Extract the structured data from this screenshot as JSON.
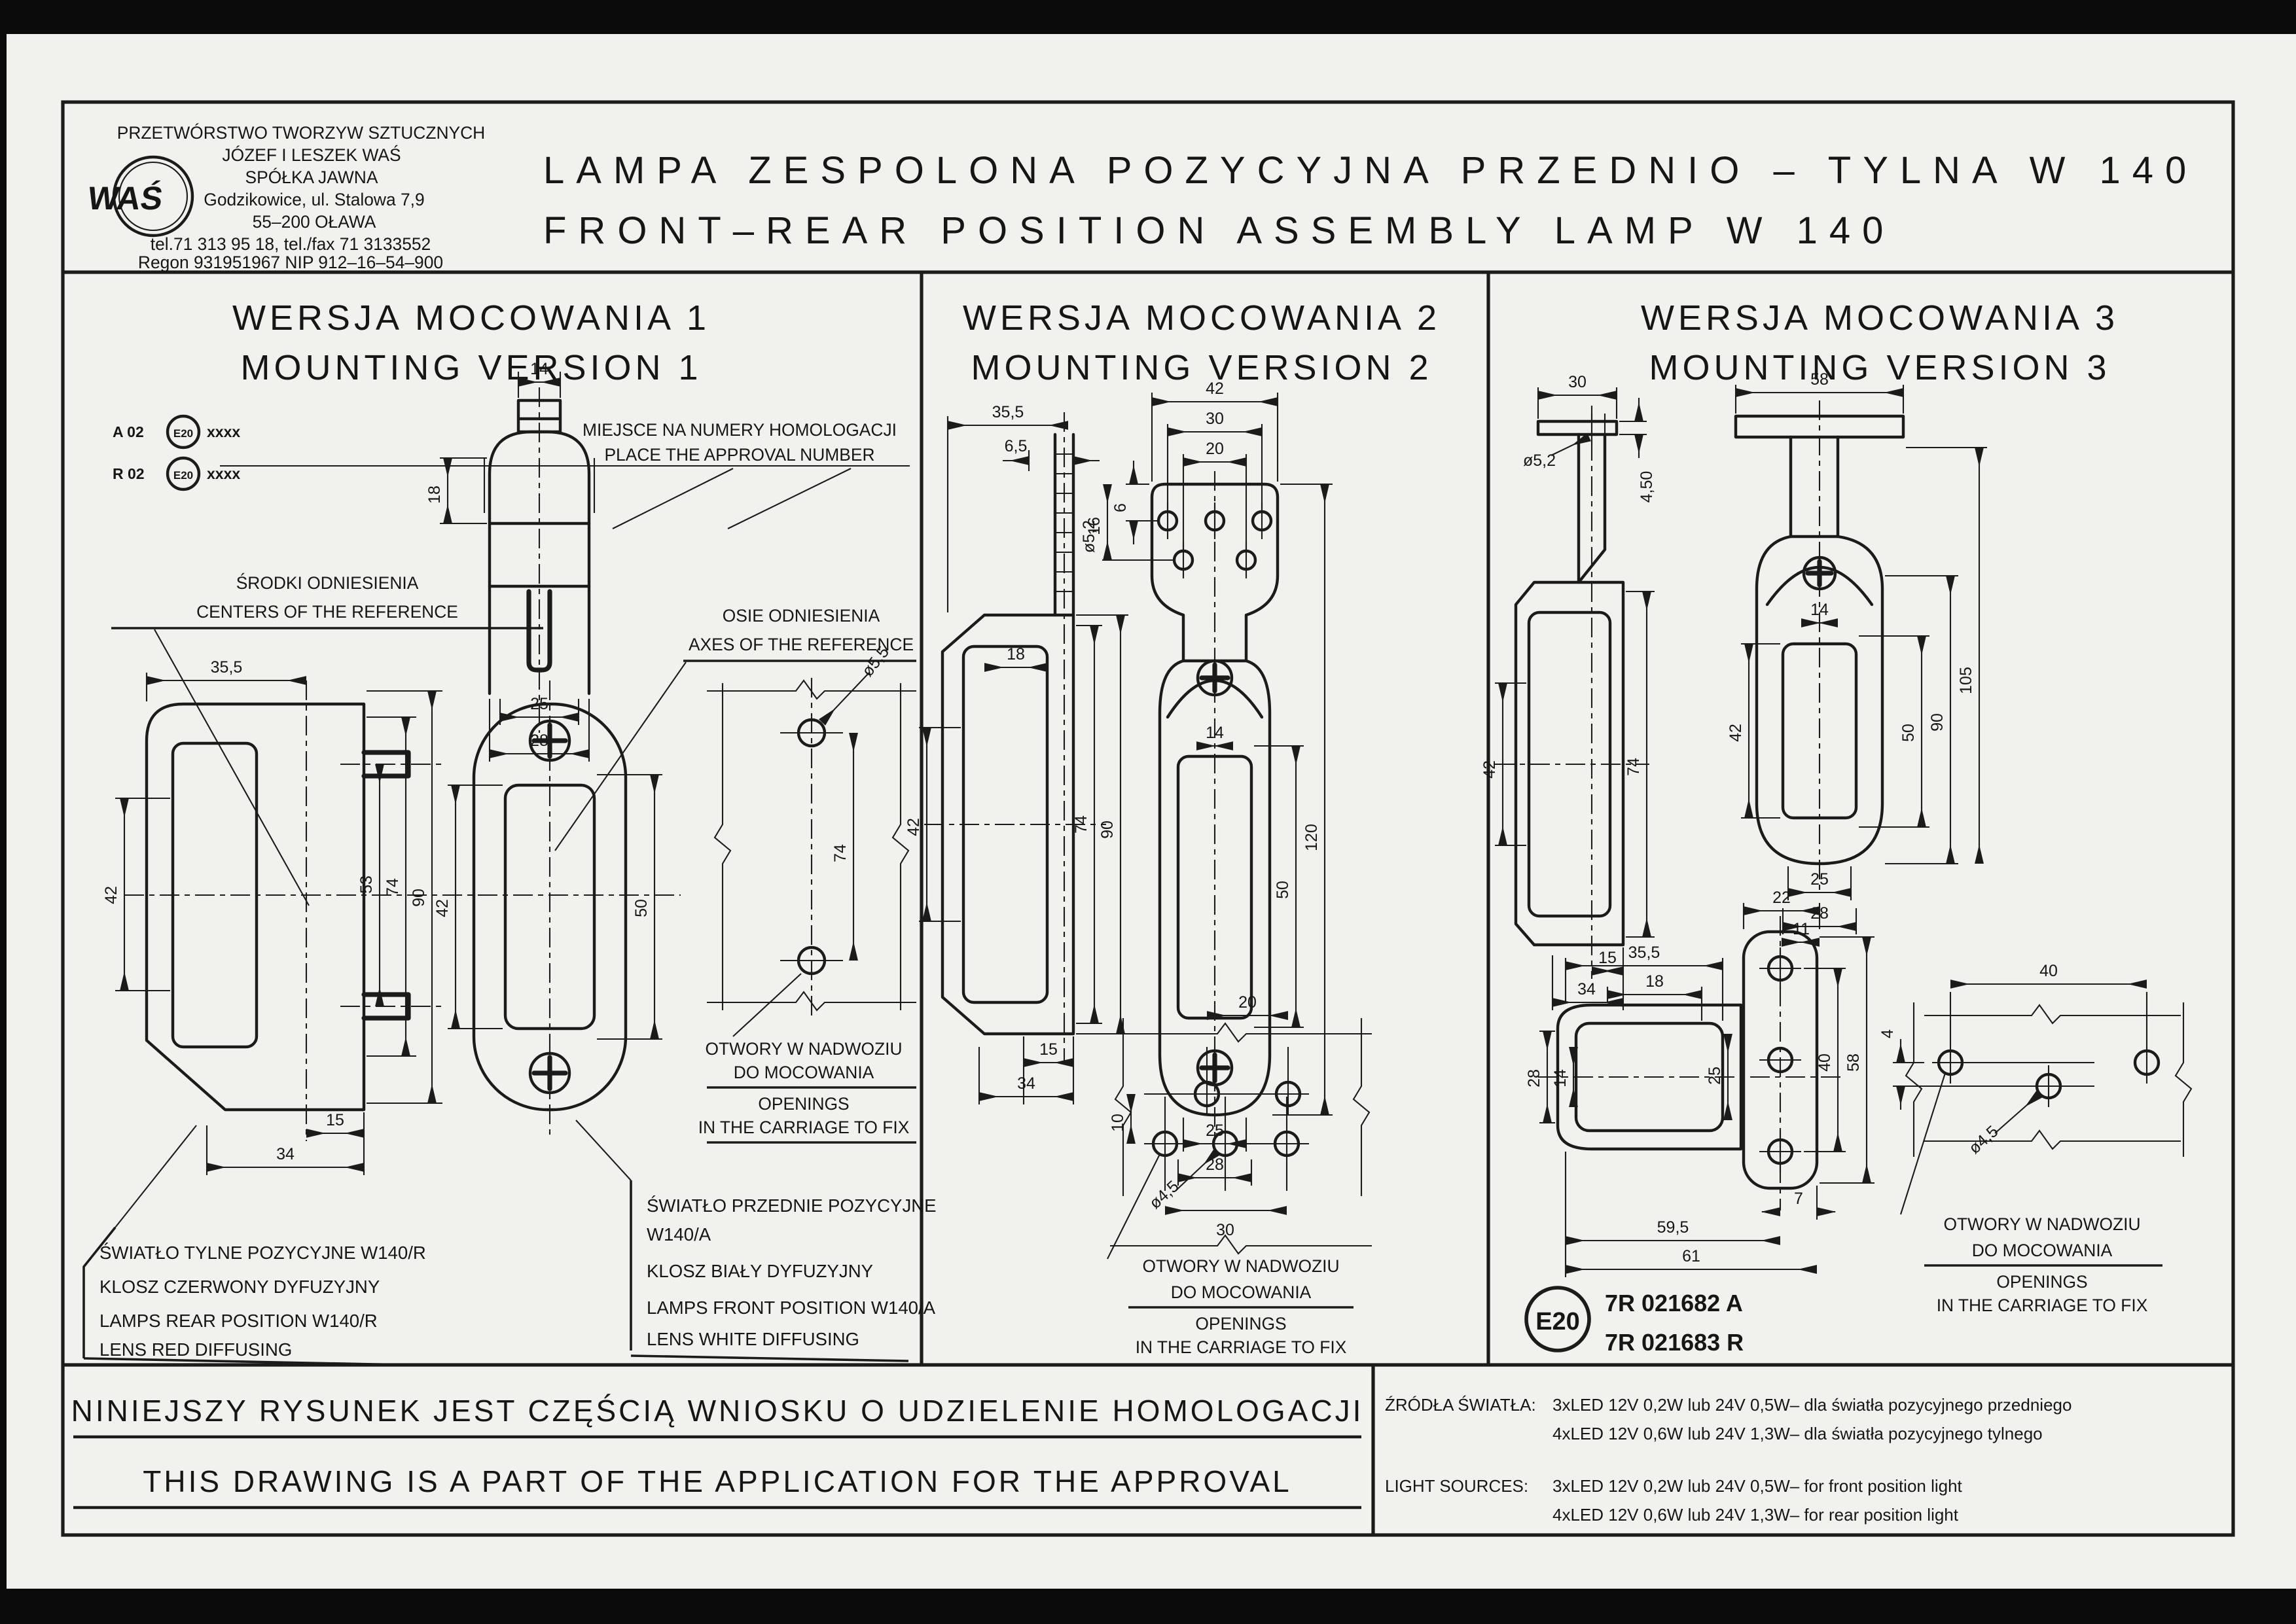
{
  "colors": {
    "paper": "#f1f1ee",
    "ink": "#1b1b1b"
  },
  "company": {
    "logo": "WAŚ",
    "lines": [
      "PRZETWÓRSTWO TWORZYW SZTUCZNYCH",
      "JÓZEF I LESZEK WAŚ",
      "SPÓŁKA JAWNA",
      "Godzikowice, ul. Stalowa 7,9",
      "55–200 OŁAWA",
      "tel.71 313 95 18, tel./fax 71 3133552",
      "Regon 931951967 NIP 912–16–54–900"
    ]
  },
  "title": {
    "pl": "LAMPA  ZESPOLONA  POZYCYJNA  PRZEDNIO  –  TYLNA  W 140",
    "en": "FRONT–REAR  POSITION  ASSEMBLY  LAMP  W 140"
  },
  "versions": [
    {
      "pl": "WERSJA  MOCOWANIA  1",
      "en": "MOUNTING  VERSION  1"
    },
    {
      "pl": "WERSJA  MOCOWANIA  2",
      "en": "MOUNTING  VERSION  2"
    },
    {
      "pl": "WERSJA  MOCOWANIA  3",
      "en": "MOUNTING  VERSION  3"
    }
  ],
  "approval_marks": {
    "row1": "A 02",
    "row2": "R 02",
    "e": "E20",
    "serial": "xxxx"
  },
  "labels": {
    "approval_place_pl": "MIEJSCE NA NUMERY HOMOLOGACJI",
    "approval_place_en": "PLACE THE APPROVAL NUMBER",
    "centers_pl": "ŚRODKI ODNIESIENIA",
    "centers_en": "CENTERS OF THE REFERENCE",
    "axes_pl": "OSIE ODNIESIENIA",
    "axes_en": "AXES OF THE REFERENCE",
    "openings_pl1": "OTWORY W NADWOZIU",
    "openings_pl2": "DO MOCOWANIA",
    "openings_en1": "OPENINGS",
    "openings_en2": "IN THE CARRIAGE TO FIX"
  },
  "dims": {
    "v1": {
      "d14": "14",
      "d18": "18",
      "d25": "25",
      "d28": "28",
      "d35_5": "35,5",
      "d42a": "42",
      "d53": "53",
      "d74a": "74",
      "d90": "90",
      "d15": "15",
      "d34": "34",
      "d42b": "42",
      "d50": "50",
      "dia5_5": "ø5,5",
      "d74b": "74"
    },
    "v2": {
      "d35_5": "35,5",
      "d6_5": "6,5",
      "dia5_2": "ø5,2",
      "d18": "18",
      "d42a": "42",
      "d74": "74",
      "d90": "90",
      "d15": "15",
      "d34": "34",
      "d42b": "42",
      "d30": "30",
      "d20": "20",
      "d6": "6",
      "d16": "16",
      "d14": "14",
      "d50": "50",
      "d120": "120",
      "d25": "25",
      "d28": "28",
      "d20b": "20",
      "d10": "10",
      "dia4_5": "ø4,5",
      "d30b": "30"
    },
    "v3": {
      "d30": "30",
      "dia5_2": "ø5,2",
      "d4_50": "4,50",
      "d42a": "42",
      "d74": "74",
      "d15": "15",
      "d34": "34",
      "d58a": "58",
      "d14a": "14",
      "d42b": "42",
      "d50": "50",
      "d90": "90",
      "d105": "105",
      "d25a": "25",
      "d28a": "28",
      "d22": "22",
      "d11": "11",
      "d35_5": "35,5",
      "d18": "18",
      "d28b": "28",
      "d14b": "14",
      "d25b": "25",
      "d40a": "40",
      "d58b": "58",
      "d7": "7",
      "d59_5": "59,5",
      "d61": "61",
      "d4": "4",
      "d40b": "40",
      "dia4_5": "ø4,5"
    }
  },
  "notes": {
    "rear": [
      "ŚWIATŁO TYLNE POZYCYJNE W140/R",
      "KLOSZ CZERWONY DYFUZYJNY",
      "LAMPS REAR POSITION W140/R",
      "LENS RED DIFFUSING"
    ],
    "front": [
      "ŚWIATŁO PRZEDNIE POZYCYJNE",
      "W140/A",
      "KLOSZ BIAŁY DYFUZYJNY",
      "LAMPS FRONT POSITION W140/A",
      "LENS WHITE DIFFUSING"
    ]
  },
  "approval_numbers": {
    "e": "E20",
    "a": "7R 021682 A",
    "r": "7R 021683 R"
  },
  "footer": {
    "statement_pl": "NINIEJSZY  RYSUNEK  JEST  CZĘŚCIĄ  WNIOSKU  O  UDZIELENIE  HOMOLOGACJI",
    "statement_en": "THIS  DRAWING  IS  A  PART  OF  THE  APPLICATION  FOR  THE  APPROVAL",
    "sources_label_pl": "ŹRÓDŁA ŚWIATŁA:",
    "sources_pl": [
      "3xLED 12V 0,2W lub 24V 0,5W–  dla światła pozycyjnego przedniego",
      "4xLED 12V 0,6W lub 24V 1,3W–  dla światła pozycyjnego tylnego"
    ],
    "sources_label_en": "LIGHT SOURCES:",
    "sources_en": [
      "3xLED 12V 0,2W lub 24V 0,5W–  for front position light",
      "4xLED 12V 0,6W lub 24V 1,3W–  for rear position light"
    ]
  }
}
